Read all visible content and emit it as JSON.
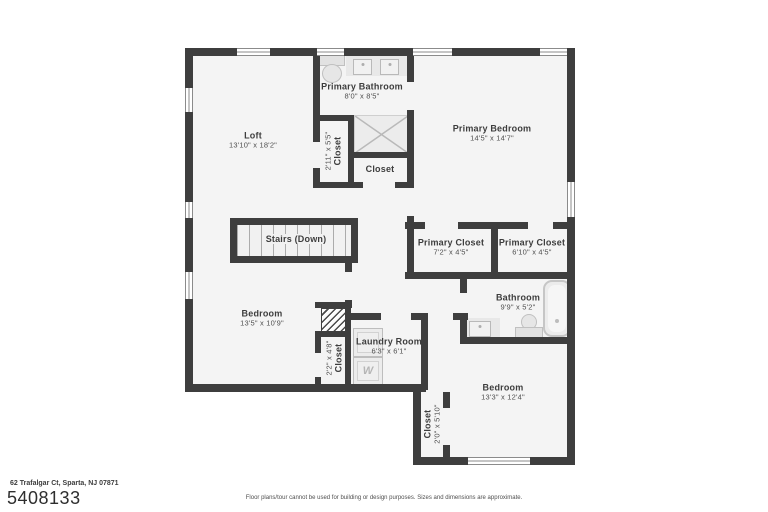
{
  "meta": {
    "address": "62 Trafalgar Ct, Sparta, NJ 07871",
    "listing_id": "5408133",
    "disclaimer": "Floor plans/tour cannot be used for building or design purposes. Sizes and dimensions are approximate."
  },
  "rooms": {
    "loft": {
      "name": "Loft",
      "dims": "13'10\" x 18'2\""
    },
    "primary_bathroom": {
      "name": "Primary Bathroom",
      "dims": "8'0\" x 8'5\""
    },
    "primary_bedroom": {
      "name": "Primary Bedroom",
      "dims": "14'5\" x 14'7\""
    },
    "closet_upper": {
      "name": "Closet",
      "dims": "2'11\" x 5'5\""
    },
    "closet_mid": {
      "name": "Closet"
    },
    "stairs": {
      "name": "Stairs (Down)"
    },
    "primary_closet_left": {
      "name": "Primary Closet",
      "dims": "7'2\" x 4'5\""
    },
    "primary_closet_right": {
      "name": "Primary Closet",
      "dims": "6'10\" x 4'5\""
    },
    "bathroom": {
      "name": "Bathroom",
      "dims": "9'9\" x 5'2\""
    },
    "bedroom_left": {
      "name": "Bedroom",
      "dims": "13'5\" x 10'9\""
    },
    "closet_small": {
      "name": "Closet",
      "dims": "2'2\" x 4'8\""
    },
    "laundry": {
      "name": "Laundry Room",
      "dims": "6'3\" x 6'1\""
    },
    "bedroom_right": {
      "name": "Bedroom",
      "dims": "13'3\" x 12'4\""
    },
    "closet_lower": {
      "name": "Closet",
      "dims": "2'0\" x 5'10\""
    }
  },
  "fixtures": {
    "washer_label": "W"
  },
  "colors": {
    "wall": "#3e3e3e",
    "floor": "#f4f4f4",
    "fixture": "#e8e8e8",
    "background": "#ffffff"
  }
}
